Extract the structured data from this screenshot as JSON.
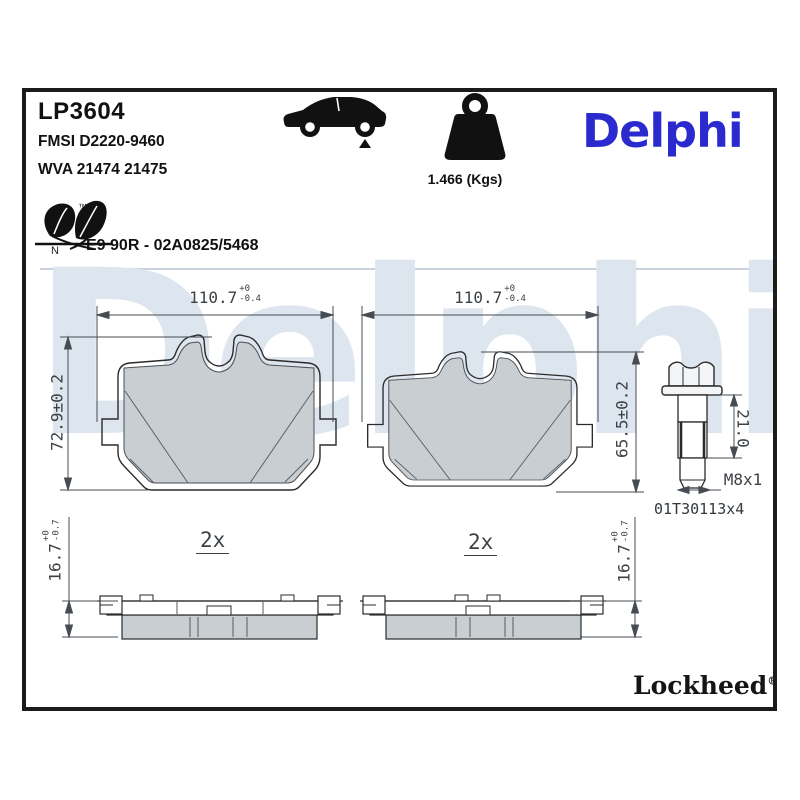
{
  "header": {
    "part_number": "LP3604",
    "fmsi_code": "FMSI D2220-9460",
    "wva_code": "WVA 21474 21475",
    "weight": "1.466 (Kgs)",
    "brand_logo": "Delphi",
    "leaf_tm": "™",
    "leaf_n": "N",
    "approval": "E9 90R - 02A0825/5468"
  },
  "drawing": {
    "watermark": "Delphi",
    "pad_front_left": {
      "width_value": "110.7",
      "width_tol_up": "+0",
      "width_tol_down": "-0.4",
      "height": "72.9±0.2"
    },
    "pad_front_right": {
      "width_value": "110.7",
      "width_tol_up": "+0",
      "width_tol_down": "-0.4",
      "height": "65.5±0.2"
    },
    "bolt": {
      "length": "21.0",
      "thread": "M8x1",
      "part_code": "01T30113x4"
    },
    "pad_side_left": {
      "qty": "2x",
      "thickness_value": "16.7",
      "thickness_tol_up": "+0",
      "thickness_tol_down": "-0.7"
    },
    "pad_side_right": {
      "qty": "2x",
      "thickness_value": "16.7",
      "thickness_tol_up": "+0",
      "thickness_tol_down": "-0.7"
    }
  },
  "footer": {
    "brand": "Lockheed",
    "reg": "®"
  },
  "colors": {
    "accent_blue": "#2a2ace",
    "watermark_blue": "#dde5ee",
    "friction_gray": "#c9ced3",
    "frame_black": "#1b1b1b"
  }
}
